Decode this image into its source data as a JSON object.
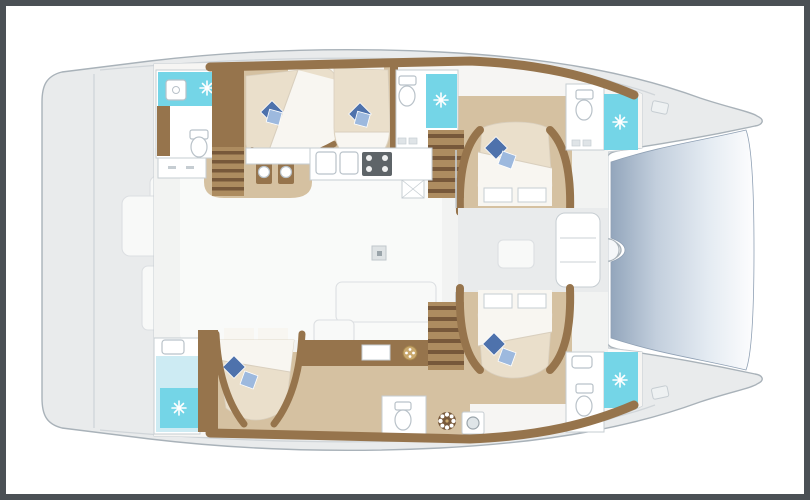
{
  "diagram": {
    "kind": "boat-floor-plan",
    "vessel_type": "sailing-catamaran",
    "view": "overhead-interior-layout",
    "areas": {
      "bridge_deck": [
        "aft-cockpit",
        "salon",
        "galley",
        "chart-sideboard",
        "forward-cockpit"
      ],
      "port_hull": [
        "aft-head-shower",
        "aft-double-cabin",
        "mid-double-cabin",
        "mid-head-shower",
        "aft-companionway-stairs",
        "forward-companionway-stairs",
        "forward-double-cabin",
        "forward-head-shower"
      ],
      "starboard_hull": [
        "aft-head-shower",
        "aft-double-cabin",
        "corridor",
        "day-head",
        "laundry-washer",
        "companionway-stairs",
        "forward-double-cabin",
        "forward-head-shower"
      ],
      "foredeck": [
        "trampoline",
        "deck-hatches"
      ]
    },
    "counts": {
      "double_berths": 5,
      "shower_rooms": 5,
      "toilets": 4,
      "staircases": 3
    },
    "icons": [
      "sparkle-shower-icon",
      "toilet-icon",
      "sink-icon",
      "stove-icon",
      "washer-icon",
      "rosette-icon",
      "pillow-pinwheel-icon"
    ]
  },
  "colors": {
    "frame": "#4b5055",
    "paper": "#ffffff",
    "hull": "#e9ebec",
    "hull-line": "#a9b2b9",
    "deck-line": "#d0d5d9",
    "cabin": "#fbfbfa",
    "wall": "#c6cdd2",
    "band": "#f6f5f3",
    "salon": "#f2f3f2",
    "tan": "#d5c1a1",
    "wood": "#96744c",
    "wood-dark": "#77583a",
    "wood-light": "#ad8c60",
    "cream": "#eadfcb",
    "duvet": "#f8f6f1",
    "duvet-line": "#d9cfbe",
    "pillow-dark": "#4e72ac",
    "pillow-light": "#9db9de",
    "cyan": "#74d5e7",
    "cyan-light": "#cdebf3",
    "tramp-dark": "#93a6bc",
    "tramp-mid": "#c3cfdd",
    "tramp-light": "#fdfdfe",
    "fixture": "#b9c2c9",
    "stove": "#5e6468",
    "gold": "#c9a86d"
  }
}
